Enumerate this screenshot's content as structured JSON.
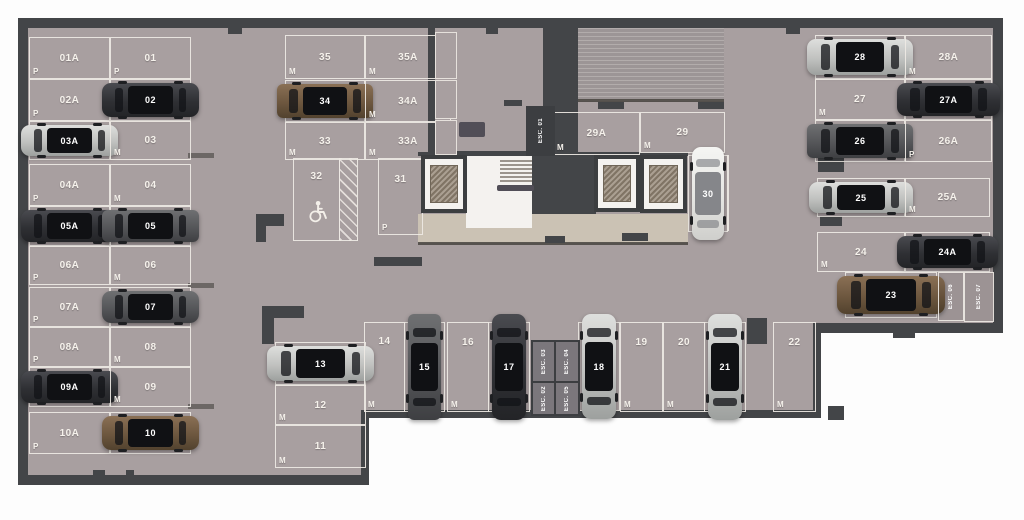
{
  "title": "underground-parking-floor-plan",
  "colors": {
    "floor": "#a89fa0",
    "wall": "#434548",
    "marking_line": "#eee9e4",
    "walkway": "#cbc2b4",
    "ramp": "#9c9596",
    "outside": "#fdfdfd",
    "car_dark": "#2f3034",
    "car_silver": "#c0c1bf",
    "car_brown": "#6d573f",
    "car_white": "#e5e5e2",
    "car_gray": "#555659"
  },
  "legend": {
    "size_small": "P",
    "size_medium": "M"
  },
  "spots": [
    {
      "id": "01A",
      "size": "P",
      "x": 29,
      "y": 37,
      "w": 79,
      "h": 40,
      "dir": "h",
      "car": null
    },
    {
      "id": "01",
      "size": "P",
      "x": 110,
      "y": 37,
      "w": 79,
      "h": 40,
      "dir": "h",
      "car": null
    },
    {
      "id": "02A",
      "size": "P",
      "x": 29,
      "y": 79,
      "w": 79,
      "h": 40,
      "dir": "h",
      "car": null
    },
    {
      "id": "02",
      "size": "M",
      "x": 110,
      "y": 79,
      "w": 79,
      "h": 40,
      "dir": "h",
      "car": {
        "color": "dark",
        "type": "sedan"
      }
    },
    {
      "id": "03A",
      "size": "P",
      "x": 29,
      "y": 121,
      "w": 79,
      "h": 37,
      "dir": "h",
      "car": {
        "color": "silver",
        "type": "sedan"
      }
    },
    {
      "id": "03",
      "size": "M",
      "x": 110,
      "y": 121,
      "w": 79,
      "h": 37,
      "dir": "h",
      "car": null
    },
    {
      "id": "04A",
      "size": "P",
      "x": 29,
      "y": 164,
      "w": 79,
      "h": 40,
      "dir": "h",
      "car": null
    },
    {
      "id": "04",
      "size": "M",
      "x": 110,
      "y": 164,
      "w": 79,
      "h": 40,
      "dir": "h",
      "car": null
    },
    {
      "id": "05A",
      "size": "P",
      "x": 29,
      "y": 206,
      "w": 79,
      "h": 38,
      "dir": "h",
      "car": {
        "color": "dark",
        "type": "sedan"
      }
    },
    {
      "id": "05",
      "size": "M",
      "x": 110,
      "y": 206,
      "w": 79,
      "h": 38,
      "dir": "h",
      "car": {
        "color": "gray",
        "type": "suv"
      }
    },
    {
      "id": "06A",
      "size": "P",
      "x": 29,
      "y": 246,
      "w": 79,
      "h": 37,
      "dir": "h",
      "car": null
    },
    {
      "id": "06",
      "size": "M",
      "x": 110,
      "y": 246,
      "w": 79,
      "h": 37,
      "dir": "h",
      "car": null
    },
    {
      "id": "07A",
      "size": "P",
      "x": 29,
      "y": 287,
      "w": 79,
      "h": 38,
      "dir": "h",
      "car": null
    },
    {
      "id": "07",
      "size": "M",
      "x": 110,
      "y": 287,
      "w": 79,
      "h": 38,
      "dir": "h",
      "car": {
        "color": "gray",
        "type": "sedan"
      }
    },
    {
      "id": "08A",
      "size": "P",
      "x": 29,
      "y": 327,
      "w": 79,
      "h": 38,
      "dir": "h",
      "car": null
    },
    {
      "id": "08",
      "size": "M",
      "x": 110,
      "y": 327,
      "w": 79,
      "h": 38,
      "dir": "h",
      "car": null
    },
    {
      "id": "09A",
      "size": "P",
      "x": 29,
      "y": 367,
      "w": 79,
      "h": 38,
      "dir": "h",
      "car": {
        "color": "dark",
        "type": "sedan"
      }
    },
    {
      "id": "09",
      "size": "M",
      "x": 110,
      "y": 367,
      "w": 79,
      "h": 38,
      "dir": "h",
      "car": null
    },
    {
      "id": "10A",
      "size": "P",
      "x": 29,
      "y": 412,
      "w": 79,
      "h": 40,
      "dir": "h",
      "car": null
    },
    {
      "id": "10",
      "size": "M",
      "x": 110,
      "y": 412,
      "w": 79,
      "h": 40,
      "dir": "h",
      "car": {
        "color": "brown",
        "type": "sedan"
      }
    },
    {
      "id": "35",
      "size": "M",
      "x": 285,
      "y": 35,
      "w": 78,
      "h": 42,
      "dir": "h",
      "car": null
    },
    {
      "id": "35A",
      "size": "M",
      "x": 365,
      "y": 35,
      "w": 84,
      "h": 42,
      "dir": "h",
      "car": null
    },
    {
      "id": "34",
      "size": "M",
      "x": 285,
      "y": 80,
      "w": 78,
      "h": 40,
      "dir": "h",
      "car": {
        "color": "brown",
        "type": "suv"
      }
    },
    {
      "id": "34A",
      "size": "M",
      "x": 365,
      "y": 80,
      "w": 84,
      "h": 40,
      "dir": "h",
      "car": null
    },
    {
      "id": "33",
      "size": "M",
      "x": 285,
      "y": 122,
      "w": 78,
      "h": 36,
      "dir": "h",
      "car": null
    },
    {
      "id": "33A",
      "size": "M",
      "x": 365,
      "y": 122,
      "w": 84,
      "h": 36,
      "dir": "h",
      "car": null
    },
    {
      "id": "32",
      "size": null,
      "x": 293,
      "y": 158,
      "w": 45,
      "h": 81,
      "dir": "v",
      "car": null,
      "accessible": true
    },
    {
      "id": "31",
      "size": "P",
      "x": 378,
      "y": 158,
      "w": 43,
      "h": 75,
      "dir": "v",
      "car": null
    },
    {
      "id": "29A",
      "size": "M",
      "x": 553,
      "y": 112,
      "w": 85,
      "h": 41,
      "dir": "h",
      "car": null
    },
    {
      "id": "29",
      "size": "M",
      "x": 640,
      "y": 112,
      "w": 83,
      "h": 39,
      "dir": "h",
      "car": null
    },
    {
      "id": "30",
      "size": "P",
      "x": 688,
      "y": 155,
      "w": 38,
      "h": 75,
      "dir": "v",
      "car": {
        "color": "white",
        "type": "sedan"
      }
    },
    {
      "id": "28",
      "size": "M",
      "x": 815,
      "y": 35,
      "w": 88,
      "h": 42,
      "dir": "h",
      "car": {
        "color": "silver",
        "type": "sedan"
      }
    },
    {
      "id": "28A",
      "size": "M",
      "x": 905,
      "y": 35,
      "w": 85,
      "h": 42,
      "dir": "h",
      "car": null
    },
    {
      "id": "27",
      "size": "M",
      "x": 815,
      "y": 79,
      "w": 88,
      "h": 39,
      "dir": "h",
      "car": null
    },
    {
      "id": "27A",
      "size": "P",
      "x": 905,
      "y": 79,
      "w": 85,
      "h": 39,
      "dir": "h",
      "car": {
        "color": "dark",
        "type": "sedan"
      }
    },
    {
      "id": "26",
      "size": "M",
      "x": 815,
      "y": 120,
      "w": 88,
      "h": 40,
      "dir": "h",
      "car": {
        "color": "gray",
        "type": "suv"
      }
    },
    {
      "id": "26A",
      "size": "P",
      "x": 905,
      "y": 120,
      "w": 85,
      "h": 40,
      "dir": "h",
      "car": null
    },
    {
      "id": "25",
      "size": "M",
      "x": 817,
      "y": 178,
      "w": 86,
      "h": 37,
      "dir": "h",
      "car": {
        "color": "silver",
        "type": "sedan"
      }
    },
    {
      "id": "25A",
      "size": "M",
      "x": 905,
      "y": 178,
      "w": 83,
      "h": 37,
      "dir": "h",
      "car": null
    },
    {
      "id": "24",
      "size": "M",
      "x": 817,
      "y": 232,
      "w": 86,
      "h": 38,
      "dir": "h",
      "car": null
    },
    {
      "id": "24A",
      "size": "M",
      "x": 905,
      "y": 232,
      "w": 83,
      "h": 38,
      "dir": "h",
      "car": {
        "color": "dark",
        "type": "sedan"
      }
    },
    {
      "id": "23",
      "size": "M",
      "x": 845,
      "y": 272,
      "w": 90,
      "h": 44,
      "dir": "h",
      "car": {
        "color": "brown",
        "type": "sedan"
      }
    },
    {
      "id": "13",
      "size": "M",
      "x": 275,
      "y": 342,
      "w": 89,
      "h": 41,
      "dir": "h",
      "car": {
        "color": "silver",
        "type": "sedan"
      }
    },
    {
      "id": "12",
      "size": "M",
      "x": 275,
      "y": 385,
      "w": 89,
      "h": 38,
      "dir": "h",
      "car": null
    },
    {
      "id": "11",
      "size": "M",
      "x": 275,
      "y": 425,
      "w": 89,
      "h": 41,
      "dir": "h",
      "car": null
    },
    {
      "id": "14",
      "size": "M",
      "x": 364,
      "y": 322,
      "w": 39,
      "h": 88,
      "dir": "v",
      "car": null
    },
    {
      "id": "15",
      "size": "M",
      "x": 404,
      "y": 322,
      "w": 39,
      "h": 88,
      "dir": "v",
      "car": {
        "color": "gray",
        "type": "suv"
      }
    },
    {
      "id": "16",
      "size": "M",
      "x": 447,
      "y": 322,
      "w": 40,
      "h": 88,
      "dir": "v",
      "car": null
    },
    {
      "id": "17",
      "size": "M",
      "x": 488,
      "y": 322,
      "w": 40,
      "h": 88,
      "dir": "v",
      "car": {
        "color": "dark",
        "type": "sedan"
      }
    },
    {
      "id": "18",
      "size": "M",
      "x": 578,
      "y": 322,
      "w": 40,
      "h": 87,
      "dir": "v",
      "car": {
        "color": "silver",
        "type": "sedan"
      }
    },
    {
      "id": "19",
      "size": "M",
      "x": 620,
      "y": 322,
      "w": 41,
      "h": 88,
      "dir": "v",
      "car": null
    },
    {
      "id": "20",
      "size": "M",
      "x": 663,
      "y": 322,
      "w": 40,
      "h": 88,
      "dir": "v",
      "car": null
    },
    {
      "id": "21",
      "size": "M",
      "x": 704,
      "y": 322,
      "w": 40,
      "h": 88,
      "dir": "v",
      "car": {
        "color": "silver",
        "type": "sedan"
      }
    },
    {
      "id": "22",
      "size": "M",
      "x": 773,
      "y": 322,
      "w": 41,
      "h": 88,
      "dir": "v",
      "car": null
    }
  ],
  "stairwells": [
    {
      "label": "ESC. 01",
      "x": 526,
      "y": 106,
      "w": 29,
      "h": 50,
      "style": "dark"
    },
    {
      "label": "ESC. 03",
      "x": 531,
      "y": 340,
      "w": 22,
      "h": 39,
      "style": "gray"
    },
    {
      "label": "ESC. 04",
      "x": 554,
      "y": 340,
      "w": 22,
      "h": 39,
      "style": "gray"
    },
    {
      "label": "ESC. 02",
      "x": 531,
      "y": 381,
      "w": 22,
      "h": 31,
      "style": "gray"
    },
    {
      "label": "ESC. 05",
      "x": 554,
      "y": 381,
      "w": 22,
      "h": 31,
      "style": "gray"
    },
    {
      "label": "ESC. 06",
      "x": 938,
      "y": 272,
      "w": 24,
      "h": 47,
      "style": "outline"
    },
    {
      "label": "ESC. 07",
      "x": 964,
      "y": 272,
      "w": 28,
      "h": 48,
      "style": "outline"
    }
  ],
  "elevators": [
    {
      "x": 421,
      "y": 155,
      "w": 46,
      "h": 58
    },
    {
      "x": 594,
      "y": 155,
      "w": 46,
      "h": 57
    },
    {
      "x": 640,
      "y": 155,
      "w": 47,
      "h": 58
    }
  ],
  "geometry": [
    {
      "kind": "floor",
      "x": 28,
      "y": 28,
      "w": 965,
      "h": 297
    },
    {
      "kind": "floor",
      "x": 28,
      "y": 325,
      "w": 787,
      "h": 87
    },
    {
      "kind": "floor",
      "x": 28,
      "y": 412,
      "w": 335,
      "h": 65
    },
    {
      "kind": "walkway",
      "x": 418,
      "y": 214,
      "w": 270,
      "h": 29
    },
    {
      "kind": "edge",
      "x": 418,
      "y": 242,
      "w": 270,
      "h": 3
    },
    {
      "kind": "ramp",
      "x": 577,
      "y": 28,
      "w": 147,
      "h": 74
    },
    {
      "kind": "edge",
      "x": 577,
      "y": 99,
      "w": 147,
      "h": 3
    },
    {
      "kind": "wall",
      "x": 18,
      "y": 18,
      "w": 985,
      "h": 10
    },
    {
      "kind": "wall",
      "x": 18,
      "y": 18,
      "w": 10,
      "h": 467
    },
    {
      "kind": "wall",
      "x": 993,
      "y": 18,
      "w": 10,
      "h": 315
    },
    {
      "kind": "wall",
      "x": 18,
      "y": 475,
      "w": 351,
      "h": 10
    },
    {
      "kind": "wall",
      "x": 361,
      "y": 410,
      "w": 8,
      "h": 75
    },
    {
      "kind": "wall",
      "x": 361,
      "y": 410,
      "w": 460,
      "h": 8
    },
    {
      "kind": "wall",
      "x": 813,
      "y": 323,
      "w": 8,
      "h": 95
    },
    {
      "kind": "wall",
      "x": 813,
      "y": 323,
      "w": 190,
      "h": 10
    },
    {
      "kind": "wall",
      "x": 549,
      "y": 25,
      "w": 29,
      "h": 131
    },
    {
      "kind": "wall",
      "x": 428,
      "y": 25,
      "w": 7,
      "h": 132
    },
    {
      "kind": "wall",
      "x": 543,
      "y": 25,
      "w": 6,
      "h": 132
    },
    {
      "kind": "wall",
      "x": 428,
      "y": 151,
      "w": 121,
      "h": 6
    },
    {
      "kind": "wall",
      "x": 418,
      "y": 152,
      "w": 270,
      "h": 4
    },
    {
      "kind": "wall",
      "x": 532,
      "y": 152,
      "w": 64,
      "h": 62
    },
    {
      "kind": "wall",
      "x": 256,
      "y": 214,
      "w": 28,
      "h": 12
    },
    {
      "kind": "wall",
      "x": 256,
      "y": 214,
      "w": 10,
      "h": 28
    },
    {
      "kind": "wall",
      "x": 262,
      "y": 306,
      "w": 42,
      "h": 12
    },
    {
      "kind": "wall",
      "x": 262,
      "y": 306,
      "w": 12,
      "h": 38
    },
    {
      "kind": "wall",
      "x": 747,
      "y": 318,
      "w": 20,
      "h": 26
    },
    {
      "kind": "wall",
      "x": 818,
      "y": 158,
      "w": 26,
      "h": 14
    },
    {
      "kind": "wall",
      "x": 820,
      "y": 216,
      "w": 22,
      "h": 10
    },
    {
      "kind": "wall",
      "x": 598,
      "y": 102,
      "w": 26,
      "h": 7
    },
    {
      "kind": "wall",
      "x": 698,
      "y": 102,
      "w": 26,
      "h": 7
    },
    {
      "kind": "wall",
      "x": 545,
      "y": 236,
      "w": 20,
      "h": 7
    },
    {
      "kind": "wall",
      "x": 622,
      "y": 233,
      "w": 26,
      "h": 8
    },
    {
      "kind": "wall",
      "x": 374,
      "y": 257,
      "w": 48,
      "h": 9
    },
    {
      "kind": "wall",
      "x": 828,
      "y": 406,
      "w": 16,
      "h": 14
    },
    {
      "kind": "wall",
      "x": 893,
      "y": 328,
      "w": 22,
      "h": 10
    },
    {
      "kind": "wall",
      "x": 228,
      "y": 28,
      "w": 14,
      "h": 6
    },
    {
      "kind": "wall",
      "x": 486,
      "y": 28,
      "w": 12,
      "h": 6
    },
    {
      "kind": "wall",
      "x": 786,
      "y": 28,
      "w": 14,
      "h": 6
    },
    {
      "kind": "wall",
      "x": 93,
      "y": 470,
      "w": 12,
      "h": 6
    },
    {
      "kind": "wall",
      "x": 126,
      "y": 470,
      "w": 8,
      "h": 6
    },
    {
      "kind": "white",
      "x": 466,
      "y": 156,
      "w": 66,
      "h": 72
    },
    {
      "kind": "tread",
      "x": 500,
      "y": 160,
      "w": 32,
      "h": 2
    },
    {
      "kind": "tread",
      "x": 500,
      "y": 164,
      "w": 32,
      "h": 2
    },
    {
      "kind": "tread",
      "x": 500,
      "y": 168,
      "w": 32,
      "h": 2
    },
    {
      "kind": "tread",
      "x": 500,
      "y": 172,
      "w": 32,
      "h": 2
    },
    {
      "kind": "tread",
      "x": 500,
      "y": 176,
      "w": 32,
      "h": 2
    },
    {
      "kind": "tread",
      "x": 500,
      "y": 180,
      "w": 32,
      "h": 2
    },
    {
      "kind": "fixture",
      "x": 497,
      "y": 185,
      "w": 37,
      "h": 6
    },
    {
      "kind": "shelf",
      "x": 435,
      "y": 32,
      "w": 20,
      "h": 45
    },
    {
      "kind": "shelf",
      "x": 435,
      "y": 80,
      "w": 20,
      "h": 37
    },
    {
      "kind": "shelf",
      "x": 435,
      "y": 120,
      "w": 20,
      "h": 33
    },
    {
      "kind": "fixture",
      "x": 459,
      "y": 122,
      "w": 26,
      "h": 15
    },
    {
      "kind": "wall",
      "x": 504,
      "y": 100,
      "w": 18,
      "h": 6
    },
    {
      "kind": "tick",
      "x": 188,
      "y": 153,
      "w": 26,
      "h": 5
    },
    {
      "kind": "tick",
      "x": 188,
      "y": 283,
      "w": 26,
      "h": 5
    },
    {
      "kind": "tick",
      "x": 188,
      "y": 404,
      "w": 26,
      "h": 5
    },
    {
      "kind": "line",
      "x": 727,
      "y": 155,
      "w": 2,
      "h": 76
    },
    {
      "kind": "hatch",
      "x": 339,
      "y": 158,
      "w": 17,
      "h": 81
    }
  ]
}
